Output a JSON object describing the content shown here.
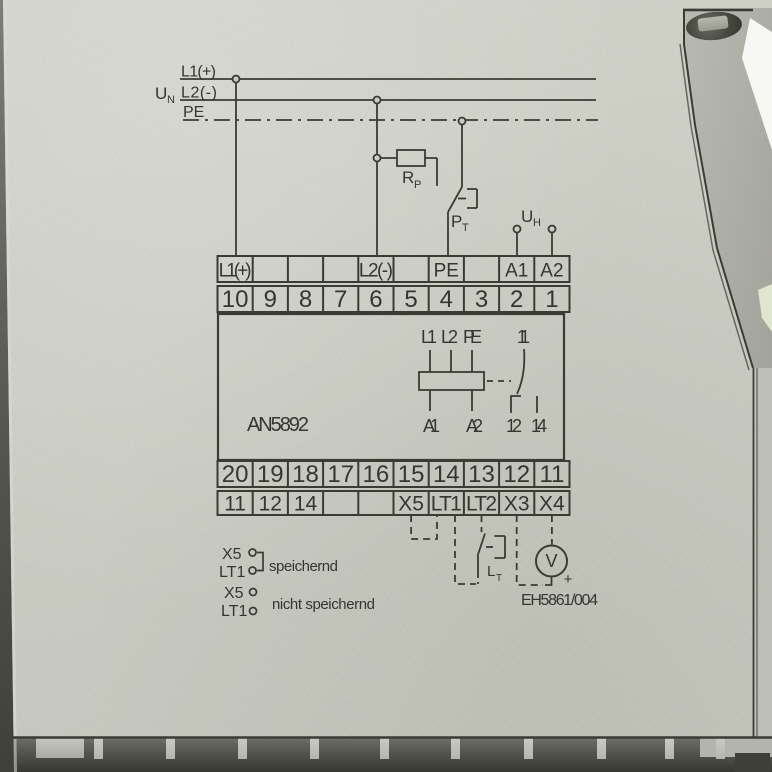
{
  "device": {
    "type_label": "AN5892",
    "drawing_number": "EH5861/004"
  },
  "colors": {
    "face": "#cbccc3",
    "ink": "#3a3b33"
  },
  "supply": {
    "l1": "L1(+)",
    "l2": "L2(-)",
    "pe": "PE",
    "un": {
      "main": "U",
      "sub": "N"
    },
    "uh": {
      "main": "U",
      "sub": "H"
    },
    "rp": {
      "main": "R",
      "sub": "P"
    },
    "pt": {
      "main": "P",
      "sub": "T"
    }
  },
  "terminal_block_top": {
    "labels": [
      "L1(+)",
      "",
      "",
      "",
      "L2(-)",
      "",
      "PE",
      "",
      "A1",
      "A2"
    ],
    "numbers": [
      "10",
      "9",
      "8",
      "7",
      "6",
      "5",
      "4",
      "3",
      "2",
      "1"
    ]
  },
  "relay": {
    "top_terminals": [
      "L1",
      "L2",
      "PE",
      "11"
    ],
    "bottom_terminals": [
      "A1",
      "A2",
      "12",
      "14"
    ]
  },
  "terminal_block_bottom": {
    "numbers": [
      "20",
      "19",
      "18",
      "17",
      "16",
      "15",
      "14",
      "13",
      "12",
      "11"
    ],
    "labels": [
      "11",
      "12",
      "14",
      "",
      "",
      "X5",
      "LT1",
      "LT2",
      "X3",
      "X4"
    ]
  },
  "external": {
    "lt": {
      "main": "L",
      "sub": "T"
    },
    "voltmeter": "V",
    "polarity": "+"
  },
  "legend": {
    "row1": {
      "a": "X5",
      "b": "LT1",
      "text": "speichernd"
    },
    "row2": {
      "a": "X5",
      "b": "LT1",
      "text": "nicht speichernd"
    }
  }
}
